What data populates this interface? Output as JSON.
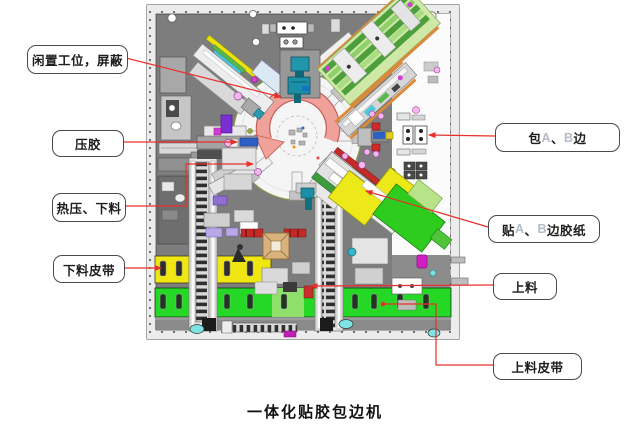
{
  "colors": {
    "leader_red": "#e8302a",
    "callout_border": "#4a4a4a",
    "ab_text_gray": "#b5bcc8",
    "panel_gray": "#7d7d7d",
    "belt_yellow": "#f0e612",
    "belt_green": "#25d825",
    "rotation_arrow_salmon": "#f0a29a"
  },
  "callouts": {
    "idle": {
      "parts": [
        {
          "text": "闲置工位，屏蔽",
          "tone": "dark"
        }
      ]
    },
    "press": {
      "parts": [
        {
          "text": "压胶",
          "tone": "dark"
        }
      ]
    },
    "hot_press": {
      "parts": [
        {
          "text": "热压、下料",
          "tone": "dark"
        }
      ]
    },
    "unload_belt": {
      "parts": [
        {
          "text": "下料皮带",
          "tone": "dark"
        }
      ]
    },
    "wrap_ab": {
      "parts": [
        {
          "text": "包",
          "tone": "dark"
        },
        {
          "text": "A",
          "tone": "light"
        },
        {
          "text": "、",
          "tone": "dark"
        },
        {
          "text": "B",
          "tone": "light"
        },
        {
          "text": "边",
          "tone": "dark"
        }
      ]
    },
    "tape_ab": {
      "parts": [
        {
          "text": "贴",
          "tone": "dark"
        },
        {
          "text": "A",
          "tone": "light"
        },
        {
          "text": "、",
          "tone": "dark"
        },
        {
          "text": "B",
          "tone": "light"
        },
        {
          "text": "边胶纸",
          "tone": "dark"
        }
      ]
    },
    "load": {
      "parts": [
        {
          "text": "上料",
          "tone": "dark"
        }
      ]
    },
    "load_belt": {
      "parts": [
        {
          "text": "上料皮带",
          "tone": "dark"
        }
      ]
    }
  },
  "caption": "一体化贴胶包边机",
  "machine": {
    "rotation_arrow_direction": "counterclockwise"
  }
}
